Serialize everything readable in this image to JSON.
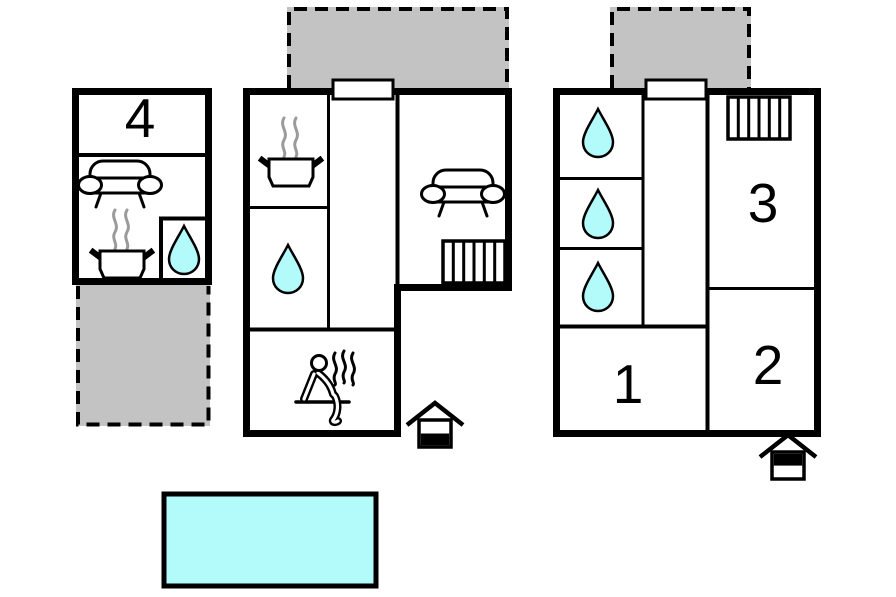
{
  "colors": {
    "background": "#ffffff",
    "outline": "#000000",
    "water": "#b3fafa",
    "terrace": "#c3c3c3",
    "steam": "#9b9b9b"
  },
  "plan": {
    "building_left": {
      "room_number": "4",
      "icons": [
        "sofa-icon",
        "cooker-icon",
        "water-drop-icon"
      ]
    },
    "building_middle": {
      "icons": [
        "cooker-icon",
        "water-drop-icon",
        "sofa-icon",
        "stairs-icon",
        "sauna-icon",
        "entrance-icon-ground"
      ]
    },
    "building_right": {
      "room_1": "1",
      "room_2": "2",
      "room_3": "3",
      "icons": [
        "water-drop-icon",
        "water-drop-icon",
        "water-drop-icon",
        "stairs-icon",
        "entrance-icon-upper"
      ]
    },
    "pool": {
      "icon": "swimming-pool"
    },
    "terraces": [
      "terrace-left",
      "terrace-middle",
      "terrace-right"
    ]
  }
}
